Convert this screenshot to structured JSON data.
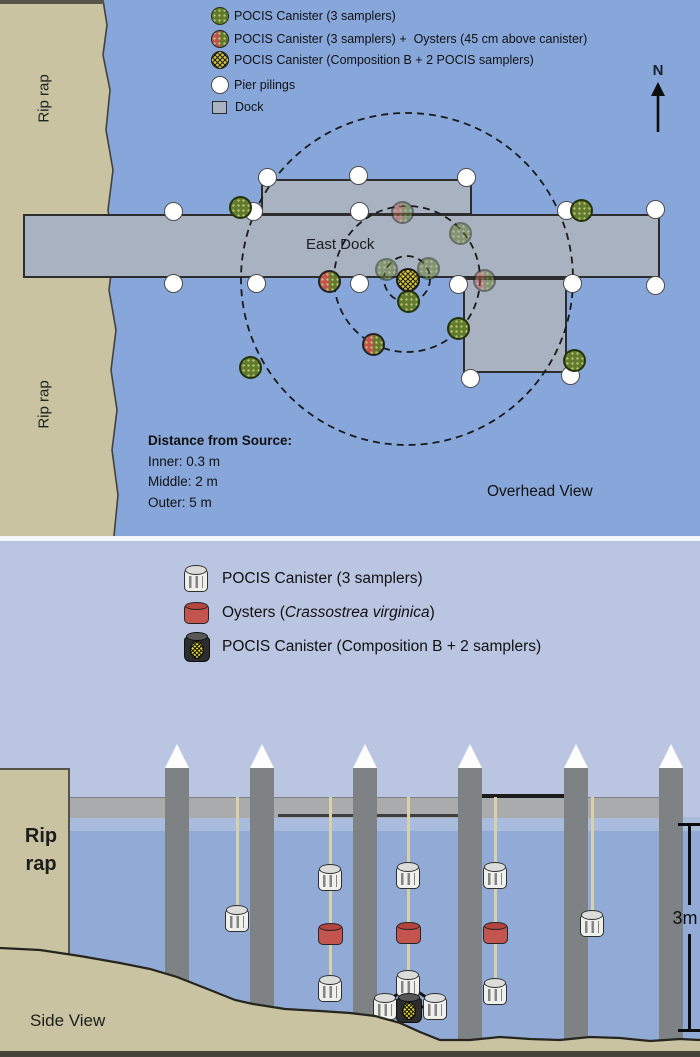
{
  "colors": {
    "water_overhead": "#87a7db",
    "shore_tan": "#c9c3a1",
    "dock_gray": "#a8b2c0",
    "sky_side": "#bac6e1",
    "water_side": "#91abd6",
    "piling_gray": "#7f8284",
    "pocis_green": "#617a2c",
    "oyster_red": "#c4544e",
    "composition_b_yellow": "#d6c832"
  },
  "overhead": {
    "legend": [
      {
        "icon": "pocis3-marker-icon",
        "label": "POCIS Canister (3 samplers)"
      },
      {
        "icon": "pocis-oyster-marker-icon",
        "label": "POCIS Canister (3 samplers) +  Oysters (45 cm above canister)"
      },
      {
        "icon": "composition-b-marker-icon",
        "label": "POCIS Canister (Composition B + 2 POCIS samplers)"
      },
      {
        "icon": "pier-piling-icon",
        "label": "Pier pilings"
      },
      {
        "icon": "dock-icon",
        "label": "Dock"
      }
    ],
    "north_label": "N",
    "rip_rap_top": "Rip rap",
    "rip_rap_bottom": "Rip rap",
    "east_dock_label": "East Dock",
    "view_label": "Overhead View",
    "distance_heading": "Distance from Source:",
    "distance_lines": [
      "Inner: 0.3 m",
      "Middle: 2 m",
      "Outer: 5 m"
    ],
    "rings": {
      "cx": 407,
      "cy": 279,
      "radii": [
        23,
        73,
        166
      ]
    },
    "docks": [
      {
        "x": 261,
        "y": 179,
        "w": 211,
        "h": 36
      },
      {
        "x": 23,
        "y": 214,
        "w": 637,
        "h": 64
      },
      {
        "x": 463,
        "y": 278,
        "w": 104,
        "h": 95
      }
    ],
    "pilings": [
      [
        267,
        177
      ],
      [
        358,
        175
      ],
      [
        466,
        177
      ],
      [
        173,
        211
      ],
      [
        253,
        211
      ],
      [
        359,
        211
      ],
      [
        566,
        210
      ],
      [
        655,
        209
      ],
      [
        173,
        283
      ],
      [
        256,
        283
      ],
      [
        359,
        283
      ],
      [
        458,
        284
      ],
      [
        572,
        283
      ],
      [
        655,
        285
      ],
      [
        470,
        378
      ],
      [
        570,
        375
      ]
    ],
    "samplers": [
      {
        "x": 240,
        "y": 207,
        "type": "pocis3",
        "faded": false
      },
      {
        "x": 581,
        "y": 210,
        "type": "pocis3",
        "faded": false
      },
      {
        "x": 574,
        "y": 360,
        "type": "pocis3",
        "faded": false
      },
      {
        "x": 250,
        "y": 367,
        "type": "pocis3",
        "faded": false
      },
      {
        "x": 458,
        "y": 328,
        "type": "pocis3",
        "faded": false
      },
      {
        "x": 408,
        "y": 301,
        "type": "pocis3",
        "faded": false
      },
      {
        "x": 386,
        "y": 269,
        "type": "pocis3",
        "faded": true
      },
      {
        "x": 428,
        "y": 268,
        "type": "pocis3",
        "faded": true
      },
      {
        "x": 460,
        "y": 233,
        "type": "pocis3",
        "faded": true
      },
      {
        "x": 373,
        "y": 344,
        "type": "pocis_oyster",
        "faded": false
      },
      {
        "x": 329,
        "y": 281,
        "type": "pocis_oyster",
        "faded": false
      },
      {
        "x": 402,
        "y": 212,
        "type": "pocis_oyster",
        "faded": true
      },
      {
        "x": 484,
        "y": 280,
        "type": "pocis_oyster",
        "faded": true
      },
      {
        "x": 408,
        "y": 280,
        "type": "compB",
        "faded": false
      }
    ]
  },
  "side": {
    "legend": [
      {
        "icon": "canister-icon",
        "label": "POCIS Canister (3 samplers)"
      },
      {
        "icon": "oyster-icon",
        "label_prefix": "Oysters (",
        "species": "Crassostrea virginica",
        "label_suffix": ")"
      },
      {
        "icon": "composition-b-canister-icon",
        "label": "POCIS Canister (Composition B + 2 samplers)"
      }
    ],
    "rip_rap_lines": [
      "Rip",
      "rap"
    ],
    "view_label": "Side View",
    "depth_label": "3m",
    "pilings_x": [
      165,
      250,
      353,
      458,
      564,
      659
    ],
    "moorings": [
      {
        "x": 237,
        "items": [
          {
            "type": "canister",
            "y": 918
          }
        ]
      },
      {
        "x": 330,
        "items": [
          {
            "type": "canister",
            "y": 877
          },
          {
            "type": "oyster",
            "y": 934
          },
          {
            "type": "canister",
            "y": 988
          }
        ]
      },
      {
        "x": 408,
        "items": [
          {
            "type": "canister",
            "y": 875
          },
          {
            "type": "oyster",
            "y": 933
          },
          {
            "type": "canister",
            "y": 983
          }
        ]
      },
      {
        "x": 495,
        "items": [
          {
            "type": "canister",
            "y": 875
          },
          {
            "type": "oyster",
            "y": 933
          },
          {
            "type": "canister",
            "y": 991
          }
        ]
      },
      {
        "x": 592,
        "items": [
          {
            "type": "canister",
            "y": 923
          }
        ]
      }
    ],
    "bottom_array": {
      "left": {
        "type": "canister",
        "x": 385,
        "y": 1006
      },
      "center": {
        "type": "compB",
        "x": 409,
        "y": 1008
      },
      "right": {
        "type": "canister",
        "x": 435,
        "y": 1006
      }
    }
  }
}
